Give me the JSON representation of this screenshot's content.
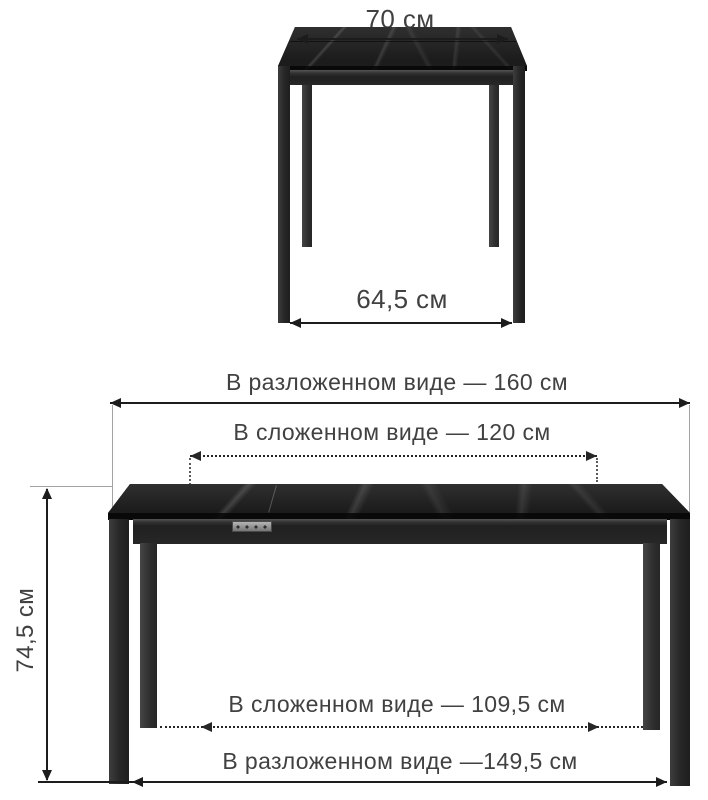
{
  "diagram": {
    "type": "furniture-dimension-diagram",
    "subject": "extendable dining table, black marble top, metal legs",
    "background": "#ffffff",
    "line_color": "#1c1c1c",
    "text_color": "#414141",
    "table_color": "#212121",
    "latch_color": "#9a9a9a",
    "top_view": {
      "width_label": "70 см",
      "depth_label": "64,5 см"
    },
    "front_view": {
      "extended_width_label": "В разложенном виде — 160 см",
      "folded_width_label": "В сложенном виде — 120 см",
      "height_label": "74,5 см",
      "folded_leg_span_label": "В сложенном виде — 109,5 см",
      "extended_leg_span_label": "В разложенном виде —149,5 см"
    }
  }
}
